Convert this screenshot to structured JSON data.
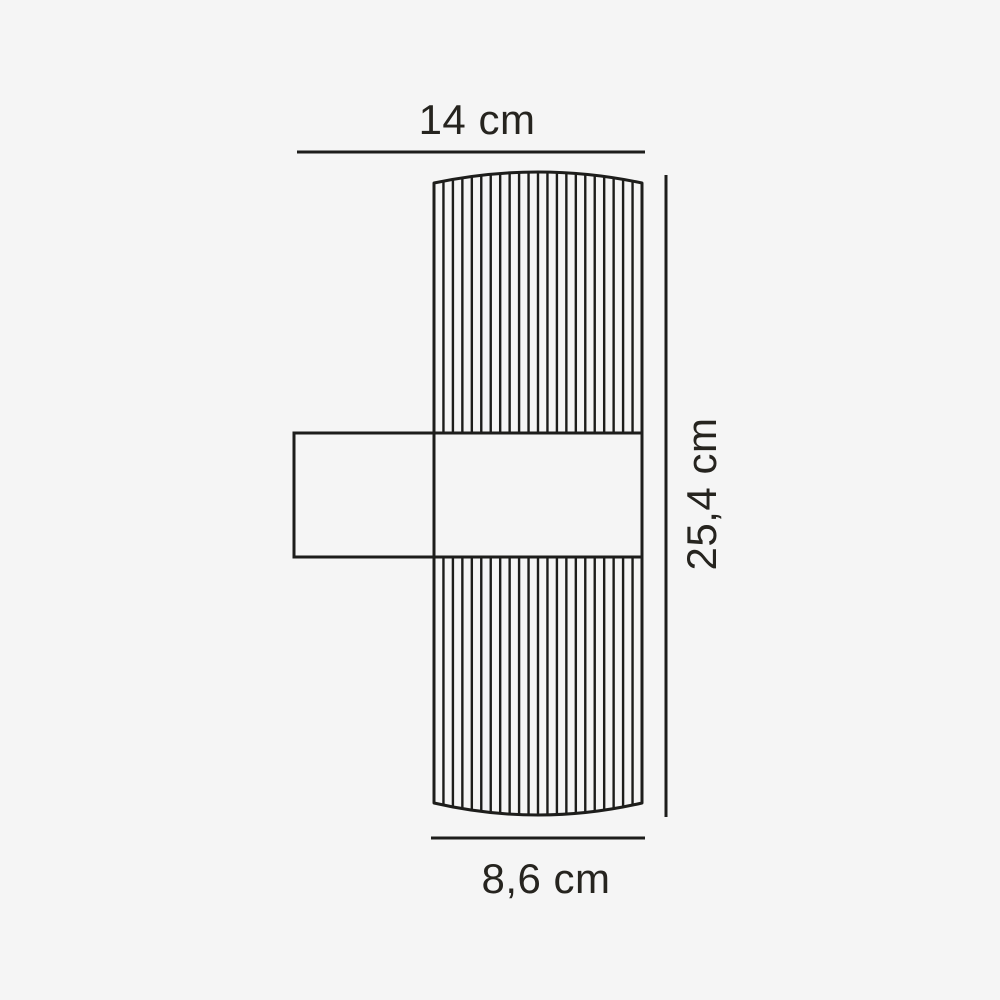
{
  "diagram": {
    "labels": {
      "width": "14 cm",
      "height": "25,4 cm",
      "diameter": "8,6 cm"
    }
  },
  "colors": {
    "line": "#1d1d1b",
    "text": "#26241f",
    "background": "#f5f5f5"
  }
}
